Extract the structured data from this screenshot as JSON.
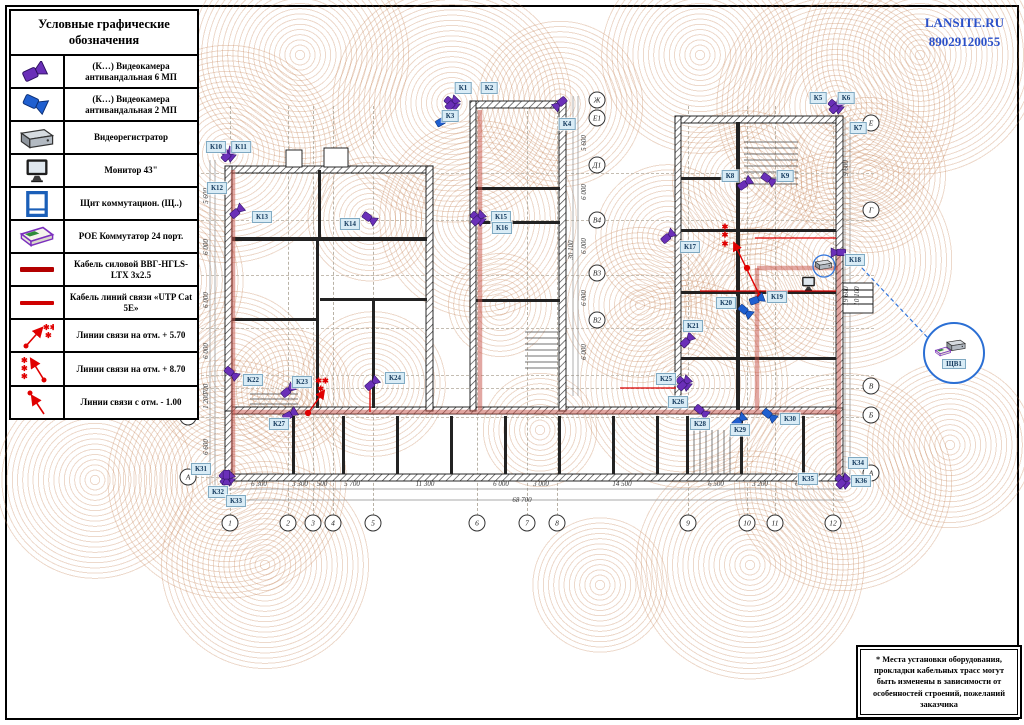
{
  "header": {
    "brand": "LANSITE.RU",
    "phone": "89029120055"
  },
  "legend": {
    "title": "Условные графические обозначения",
    "rows": [
      {
        "icon": "camera-6mp-icon",
        "label": "(К…) Видеокамера антивандальная 6 МП"
      },
      {
        "icon": "camera-2mp-icon",
        "label": "(К…) Видеокамера антивандальная 2 МП"
      },
      {
        "icon": "dvr-icon",
        "label": "Видеорегистратор"
      },
      {
        "icon": "monitor-icon",
        "label": "Монитор 43\""
      },
      {
        "icon": "panel-icon",
        "label": "Щит коммутацион. (Щ..)"
      },
      {
        "icon": "poe-icon",
        "label": "POE Коммутатор 24 порт."
      },
      {
        "icon": "power-cable-icon",
        "label": "Кабель силовой ВВГ-НГLS-LTX 3х2.5"
      },
      {
        "icon": "utp-cable-icon",
        "label": "Кабель линий связи «UTP Cat 5E»"
      },
      {
        "icon": "link-570-icon",
        "label": "Линии связи на отм.  + 5.70"
      },
      {
        "icon": "link-870-icon",
        "label": "Линии связи на отм.  + 8.70"
      },
      {
        "icon": "link-m100-icon",
        "label": "Линии связи с отм.  - 1.00"
      }
    ]
  },
  "note": {
    "text": "* Места установки оборудования, прокладки кабельных трасс могут быть изменены в зависимости от особенностей строений, пожеланий заказчика"
  },
  "plan": {
    "callout_label": "ЩВ1",
    "camera_labels": [
      [
        "К1",
        463,
        88
      ],
      [
        "К2",
        489,
        88
      ],
      [
        "К3",
        450,
        116
      ],
      [
        "К4",
        567,
        124
      ],
      [
        "К5",
        818,
        98
      ],
      [
        "К6",
        846,
        98
      ],
      [
        "К7",
        858,
        128
      ],
      [
        "К8",
        730,
        176
      ],
      [
        "К9",
        785,
        176
      ],
      [
        "К10",
        216,
        147
      ],
      [
        "К11",
        241,
        147
      ],
      [
        "К12",
        217,
        188
      ],
      [
        "К13",
        262,
        217
      ],
      [
        "К14",
        350,
        224
      ],
      [
        "К15",
        501,
        217
      ],
      [
        "К16",
        502,
        228
      ],
      [
        "К17",
        690,
        247
      ],
      [
        "К18",
        855,
        260
      ],
      [
        "К19",
        777,
        297
      ],
      [
        "К20",
        726,
        303
      ],
      [
        "К21",
        693,
        326
      ],
      [
        "К22",
        253,
        380
      ],
      [
        "К23",
        302,
        382
      ],
      [
        "К24",
        395,
        378
      ],
      [
        "К25",
        666,
        379
      ],
      [
        "К26",
        678,
        402
      ],
      [
        "К27",
        279,
        424
      ],
      [
        "К28",
        700,
        424
      ],
      [
        "К29",
        740,
        430
      ],
      [
        "К30",
        790,
        419
      ],
      [
        "К31",
        201,
        469
      ],
      [
        "К32",
        218,
        492
      ],
      [
        "К33",
        236,
        501
      ],
      [
        "К34",
        858,
        463
      ],
      [
        "К35",
        808,
        479
      ],
      [
        "К36",
        861,
        481
      ]
    ],
    "camera_icons": [
      [
        452,
        103,
        "p",
        40
      ],
      [
        452,
        103,
        "p",
        -45
      ],
      [
        560,
        104,
        "p",
        140
      ],
      [
        443,
        120,
        "b",
        -30
      ],
      [
        836,
        106,
        "p",
        40
      ],
      [
        836,
        106,
        "p",
        -45
      ],
      [
        228,
        154,
        "p",
        40
      ],
      [
        228,
        154,
        "p",
        -45
      ],
      [
        237,
        211,
        "p",
        -40
      ],
      [
        370,
        218,
        "p",
        35
      ],
      [
        478,
        218,
        "p",
        40
      ],
      [
        478,
        218,
        "p",
        -45
      ],
      [
        745,
        183,
        "p",
        -35
      ],
      [
        769,
        179,
        "p",
        35
      ],
      [
        668,
        236,
        "p",
        -40
      ],
      [
        838,
        253,
        "p",
        180
      ],
      [
        757,
        299,
        "b",
        -20
      ],
      [
        746,
        311,
        "b",
        40
      ],
      [
        687,
        340,
        "p",
        -45
      ],
      [
        232,
        373,
        "p",
        40
      ],
      [
        288,
        390,
        "p",
        -40
      ],
      [
        372,
        383,
        "p",
        -40
      ],
      [
        684,
        383,
        "p",
        40
      ],
      [
        684,
        383,
        "p",
        -45
      ],
      [
        290,
        414,
        "p",
        -30
      ],
      [
        702,
        411,
        "p",
        40
      ],
      [
        739,
        420,
        "b",
        -40
      ],
      [
        770,
        415,
        "b",
        40
      ],
      [
        227,
        478,
        "p",
        40
      ],
      [
        227,
        478,
        "p",
        -45
      ],
      [
        227,
        478,
        "p",
        90
      ],
      [
        843,
        481,
        "p",
        40
      ],
      [
        843,
        481,
        "p",
        -45
      ]
    ],
    "axes_bottom": [
      [
        "1",
        230
      ],
      [
        "2",
        288
      ],
      [
        "3",
        313
      ],
      [
        "4",
        333
      ],
      [
        "5",
        373
      ],
      [
        "6",
        477
      ],
      [
        "7",
        527
      ],
      [
        "8",
        557
      ],
      [
        "9",
        688
      ],
      [
        "10",
        747
      ],
      [
        "11",
        775
      ],
      [
        "12",
        833
      ]
    ],
    "axes_left": [
      [
        "Д",
        173
      ],
      [
        "В4",
        220
      ],
      [
        "В3",
        275
      ],
      [
        "В2",
        328
      ],
      [
        "В1",
        375
      ],
      [
        "В",
        388
      ],
      [
        "Б",
        417
      ],
      [
        "А",
        477
      ]
    ],
    "axes_mid": [
      [
        "Ж",
        100
      ],
      [
        "Е1",
        118
      ],
      [
        "Д1",
        165
      ],
      [
        "В4",
        220
      ],
      [
        "В3",
        273
      ],
      [
        "В2",
        320
      ]
    ],
    "axes_right": [
      [
        "Е",
        123
      ],
      [
        "Г",
        210
      ],
      [
        "В",
        386
      ],
      [
        "Б",
        415
      ],
      [
        "А",
        473
      ]
    ],
    "dims_bottom": [
      [
        "6 300",
        259
      ],
      [
        "3 300",
        300
      ],
      [
        "500",
        322
      ],
      [
        "5 700",
        352
      ],
      [
        "11 300",
        425
      ],
      [
        "6 000",
        501
      ],
      [
        "3 000",
        541
      ],
      [
        "14 500",
        622
      ],
      [
        "6 500",
        716
      ],
      [
        "3 200",
        760
      ],
      [
        "6 400",
        803
      ]
    ],
    "dims_total": {
      "text": "68 700",
      "x": 522,
      "y": 504
    },
    "dims_left": [
      [
        "6 600",
        447
      ],
      [
        "1 200",
        401
      ],
      [
        "700",
        389
      ],
      [
        "6 000",
        351
      ],
      [
        "6 000",
        300
      ],
      [
        "6 000",
        247
      ],
      [
        "5 600",
        196
      ]
    ],
    "dims_left_total": {
      "text": "38 600",
      "y": 300
    },
    "dims_mid": [
      [
        "5 600",
        143
      ],
      [
        "6 000",
        192
      ],
      [
        "6 000",
        246
      ],
      [
        "6 000",
        298
      ],
      [
        "6 000",
        352
      ]
    ],
    "dims_mid_total": {
      "text": "30 100",
      "y": 250
    },
    "dims_right": [
      [
        "9 600",
        168
      ],
      [
        "19 600",
        296
      ]
    ],
    "dims_right2": [
      [
        "10 100",
        296
      ]
    ],
    "elev_marks": [
      {
        "x": 322,
        "y": 386,
        "lines": "✱✱\n ✱"
      },
      {
        "x": 725,
        "y": 236,
        "lines": "✱\n✱\n✱"
      }
    ]
  }
}
